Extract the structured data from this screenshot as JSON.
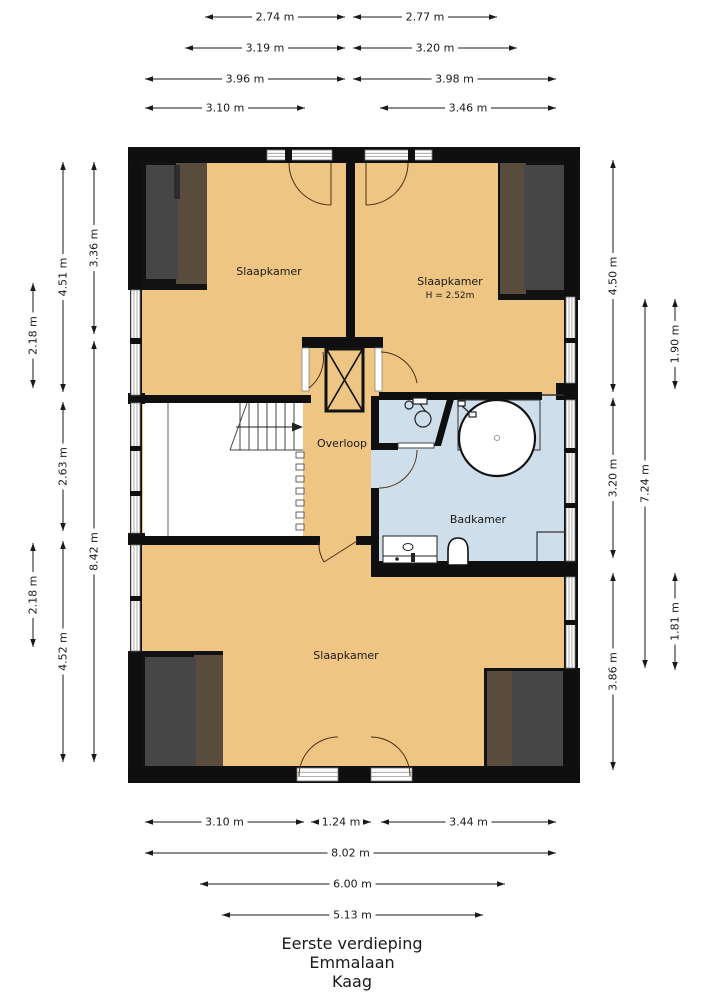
{
  "title_block": {
    "floor": "Eerste verdieping",
    "street": "Emmalaan",
    "city": "Kaag"
  },
  "rooms": {
    "bedroom_top_left": "Slaapkamer",
    "bedroom_top_right": "Slaapkamer",
    "bedroom_top_right_height": "H = 2.52m",
    "landing": "Overloop",
    "bathroom": "Badkamer",
    "bedroom_bottom": "Slaapkamer"
  },
  "dims": {
    "top": [
      "2.74 m",
      "2.77 m",
      "3.19 m",
      "3.20 m",
      "3.96 m",
      "3.98 m",
      "3.10 m",
      "3.46 m"
    ],
    "left": [
      "2.18 m",
      "2.18 m",
      "4.51 m",
      "2.63 m",
      "4.52 m",
      "3.36 m",
      "8.42 m"
    ],
    "right": [
      "4.50 m",
      "3.20 m",
      "3.86 m",
      "7.24 m",
      "1.90 m",
      "1.81 m"
    ],
    "bottom": [
      "3.10 m",
      "1.24 m",
      "3.44 m",
      "8.02 m",
      "6.00 m",
      "5.13 m"
    ]
  },
  "colors": {
    "room_fill": "#EEC583",
    "bath_fill": "#CFDEEB",
    "wall": "#0f0f0f",
    "panel_gray": "#464646",
    "panel_brown": "#5A4C3C",
    "arc_stroke": "#4a3115"
  }
}
